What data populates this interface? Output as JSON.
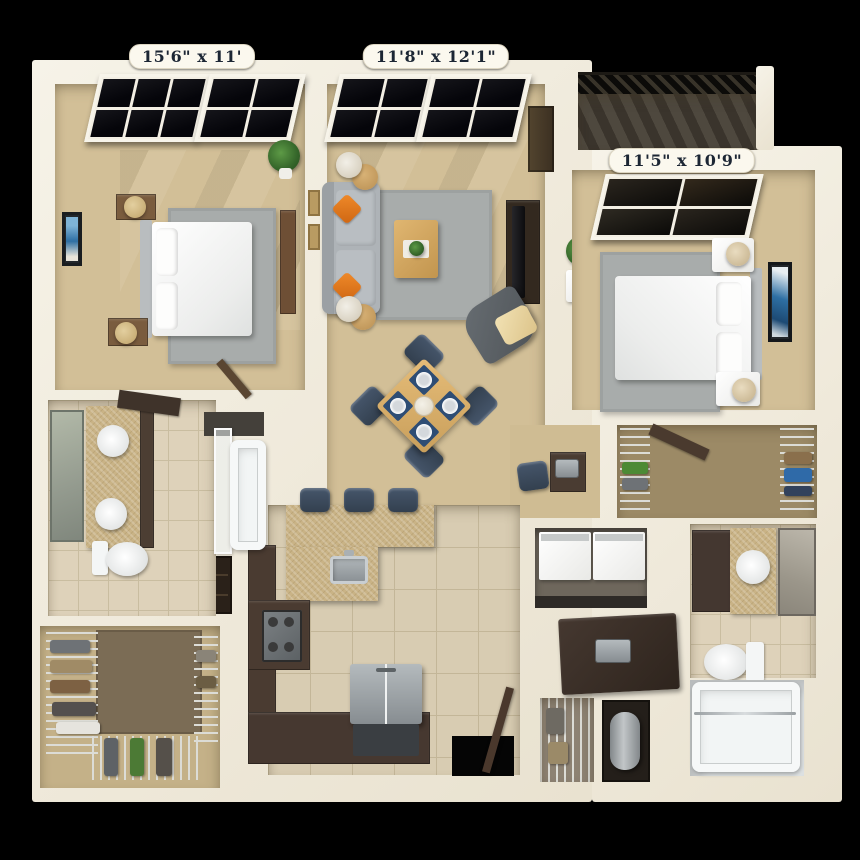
{
  "floorplan": {
    "dimensions": {
      "bedroom1": "15'6\" x 11'",
      "living_room": "11'8\" x 12'1\"",
      "bedroom2": "11'5\" x 10'9\""
    },
    "palette": {
      "background": "#000000",
      "wall_cream": "#f2eee1",
      "carpet_tan": "#d2bf97",
      "tile_beige": "#d8ccb2",
      "granite": "#c9b386",
      "cabinet_dark_brown": "#4a3b31",
      "rug_gray": "#a8acab",
      "sofa_gray": "#aeb3b7",
      "accent_orange": "#dd7722",
      "chair_navy": "#3c4a5c",
      "wood": "#dcb271",
      "deck_dark": "#45403a",
      "plant_green": "#3f7a33"
    }
  }
}
